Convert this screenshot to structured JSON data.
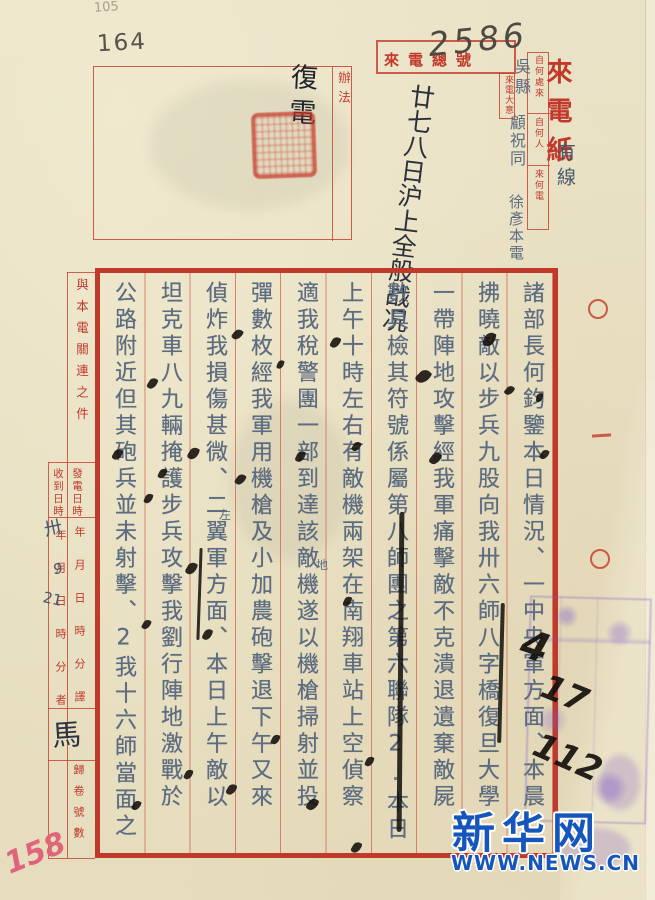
{
  "pencil": {
    "faint_no": "105",
    "page_no": "164",
    "bottom_no": "158",
    "big_no": "2586",
    "black_marks": [
      "4",
      "17",
      "112"
    ],
    "translator_sig": "馬",
    "recv_year": "卅",
    "recv_month": "9",
    "recv_day": "21"
  },
  "header": {
    "incoming_no_label": "來電總號",
    "paper_title": "來電紙",
    "line_type": "有線",
    "origin_fields": [
      {
        "label": "自何處來",
        "value": "吳縣"
      },
      {
        "label": "自何人",
        "value": "顧祝同"
      },
      {
        "label": "來何電",
        "value": "徐彥本電"
      }
    ],
    "summary_label": "來電大意",
    "summary_value": "廿七八日沪上全般战况",
    "action_label": "辦法",
    "action_value": "復電"
  },
  "side_form": {
    "related_label": "與本電關連之件",
    "sent_label": "發電日時",
    "recv_label": "收到日時",
    "units_sent": "年月日時分譯",
    "units_recv": "年月日時分者",
    "file_label": "歸卷號數",
    "margin_file_no": "〇一〇"
  },
  "body": {
    "columns": [
      "諸部長何鈞鑒本日情況、一中央軍方面、本晨",
      "拂曉敵以步兵九股向我卅六師八字橋復旦大學",
      "一帶陣地攻擊經我軍痛擊敵不克潰退遺棄敵屍",
      "數具檢其符號係屬第八師團之第六聯隊2.本日",
      "上午十時左右有敵機兩架在南翔車站上空偵察",
      "適我稅警團一部到達該敵機遂以機槍掃射並投",
      "彈數枚經我軍用機槍及小加農砲擊退下午又來",
      "偵炸我損傷甚微、二翼軍方面、本日上午敵以",
      "坦克車八九輛掩護步兵攻擊我劉行陣地激戰於",
      "公路附近但其砲兵並未射擊、2我十六師當面之"
    ],
    "insert_1": "地",
    "insert_2": "左"
  },
  "watermark": {
    "site": "新华网",
    "url": "WWW.NEWS.CN"
  }
}
